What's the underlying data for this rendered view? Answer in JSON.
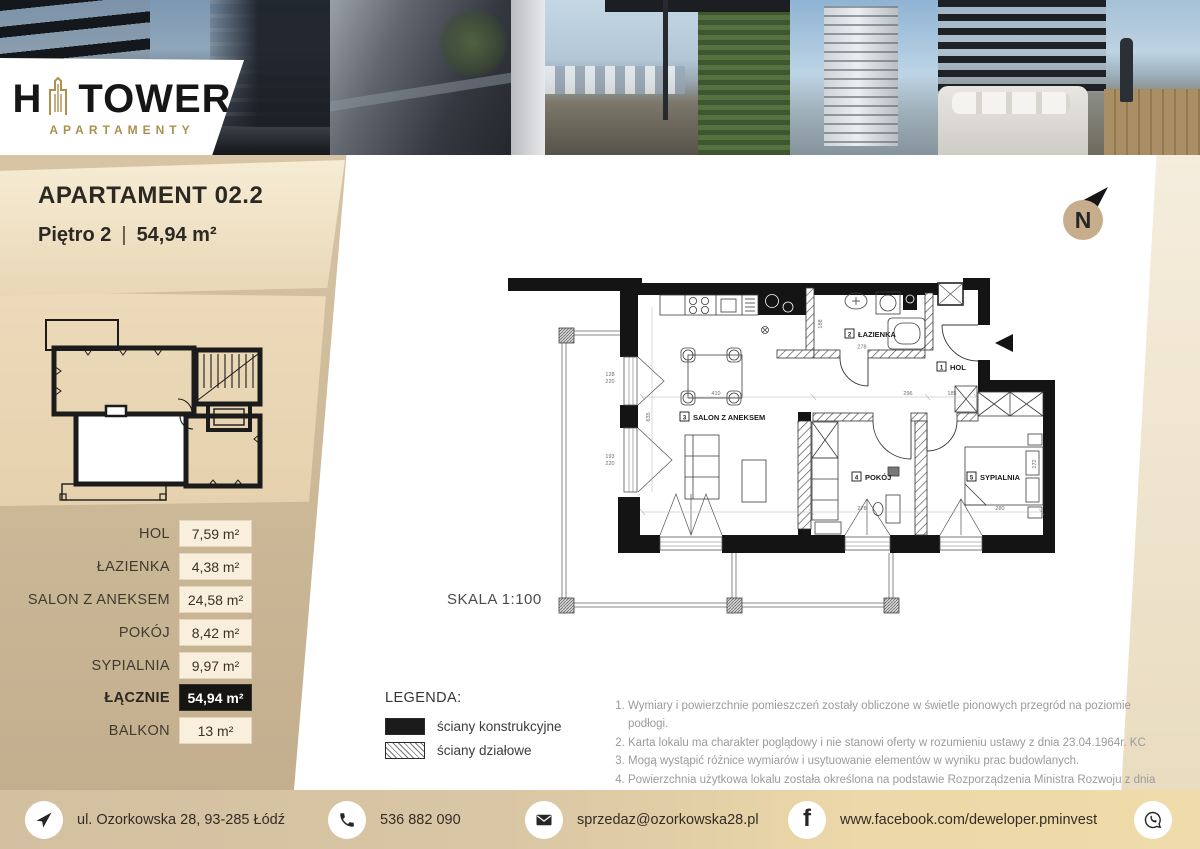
{
  "logo": {
    "h": "H",
    "tower": "TOWER",
    "subtitle": "APARTAMENTY"
  },
  "unit": {
    "title": "APARTAMENT 02.2",
    "floor": "Piętro 2",
    "sep": "|",
    "area": "54,94 m²"
  },
  "north": {
    "label": "N"
  },
  "rooms": [
    {
      "name": "HOL",
      "area": "7,59 m²"
    },
    {
      "name": "ŁAZIENKA",
      "area": "4,38 m²"
    },
    {
      "name": "SALON Z ANEKSEM",
      "area": "24,58 m²"
    },
    {
      "name": "POKÓJ",
      "area": "8,42 m²"
    },
    {
      "name": "SYPIALNIA",
      "area": "9,97 m²"
    },
    {
      "name": "ŁĄCZNIE",
      "area": "54,94 m²"
    },
    {
      "name": "BALKON",
      "area": "13 m²"
    }
  ],
  "plan": {
    "scale_label": "SKALA 1:100",
    "labels": [
      {
        "num": "1",
        "name": "HOL"
      },
      {
        "num": "2",
        "name": "ŁAZIENKA"
      },
      {
        "num": "3",
        "name": "SALON Z ANEKSEM"
      },
      {
        "num": "4",
        "name": "POKÓJ"
      },
      {
        "num": "5",
        "name": "SYPIALNIA"
      }
    ],
    "dims": {
      "bath_w": "278",
      "bath_h": "188",
      "hol_top": "296",
      "hol": "185",
      "salon_w": "410",
      "salon_h": "635",
      "pokoj_w": "278",
      "syp_w": "280",
      "syp_h": "172",
      "door1_a": "128",
      "door1_b": "220",
      "door2_a": "193",
      "door2_b": "220"
    }
  },
  "legend": {
    "title": "LEGENDA:",
    "items": [
      {
        "label": "ściany konstrukcyjne",
        "style": "solid"
      },
      {
        "label": "ściany działowe",
        "style": "hatched"
      }
    ]
  },
  "notes": [
    "Wymiary i powierzchnie pomieszczeń zostały obliczone w świetle pionowych przegród na poziomie podłogi.",
    "Karta lokalu ma charakter poglądowy i nie stanowi oferty w rozumieniu ustawy z dnia 23.04.1964r. KC",
    "Mogą wystąpić różnice wymiarów i usytuowanie elementów w wyniku prac budowlanych.",
    "Powierzchnia użytkowa lokalu została określona na podstawie Rozporządzenia Ministra Rozwoju z dnia 11 września 2020r., w sprawie szczegółowego zakresu i formy projektu budowlanego oraz zgodnie z Polską Normą PN-ISO 9836:2022-07"
  ],
  "footer": {
    "address": "ul. Ozorkowska 28, 93-285 Łódź",
    "phone": "536 882 090",
    "email": "sprzedaz@ozorkowska28.pl",
    "facebook": "www.facebook.com/deweloper.pminvest",
    "facebook_glyph": "f"
  },
  "colors": {
    "accent_gold": "#ad8f4e",
    "sidebar_tan": "#cbb897",
    "panel_cream": "#f6ecd4",
    "value_box": "#f9efdc",
    "total_box": "#171513",
    "footer_right_gold": "#f0dcaa",
    "wall_black": "#141414"
  }
}
